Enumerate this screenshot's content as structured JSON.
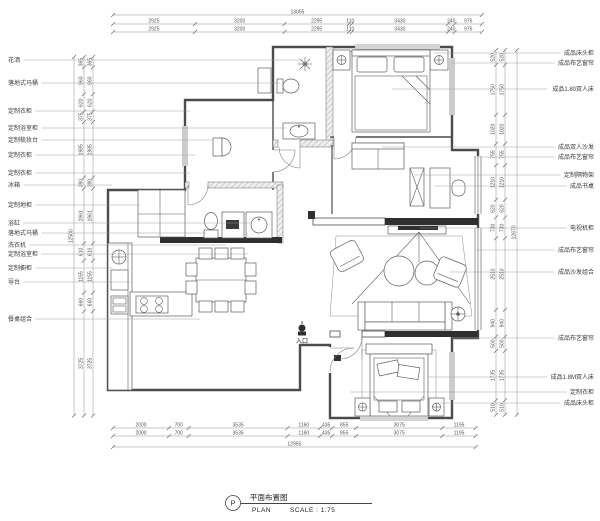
{
  "drawing_title": {
    "letter": "P",
    "title_cn": "平面布置图",
    "plan_label": "PLAN",
    "scale_label": "SCALE : 1:75"
  },
  "entry": {
    "label": "入口"
  },
  "colors": {
    "line": "#4b4b4b",
    "wall_fill": "#2f2f2f",
    "hatch": "#bdbdbd",
    "dim": "#8f8f8f"
  },
  "left_labels": [
    {
      "text": "花洒",
      "y": 60,
      "tx": 300
    },
    {
      "text": "落地式马桶",
      "y": 83,
      "tx": 280
    },
    {
      "text": "定制衣柜",
      "y": 111,
      "tx": 190
    },
    {
      "text": "定制浴室柜",
      "y": 128,
      "tx": 286
    },
    {
      "text": "定制梳妆台",
      "y": 140,
      "tx": 213
    },
    {
      "text": "定制衣柜",
      "y": 155,
      "tx": 195
    },
    {
      "text": "定制衣柜",
      "y": 173,
      "tx": 190
    },
    {
      "text": "冰箱",
      "y": 185,
      "tx": 112
    },
    {
      "text": "定制地柜",
      "y": 205,
      "tx": 140
    },
    {
      "text": "浴缸",
      "y": 223,
      "tx": 250
    },
    {
      "text": "落地式马桶",
      "y": 233,
      "tx": 206
    },
    {
      "text": "洗衣机",
      "y": 245,
      "tx": 226
    },
    {
      "text": "定制浴室柜",
      "y": 254,
      "tx": 248
    },
    {
      "text": "定制橱柜",
      "y": 268,
      "tx": 112
    },
    {
      "text": "导台",
      "y": 282,
      "tx": 130
    },
    {
      "text": "餐桌组合",
      "y": 319,
      "tx": 200
    }
  ],
  "right_labels": [
    {
      "text": "成品床头柜",
      "y": 53,
      "tx": 434
    },
    {
      "text": "成品布艺窗帘",
      "y": 63,
      "tx": 452
    },
    {
      "text": "成品1.80双人床",
      "y": 89,
      "tx": 392
    },
    {
      "text": "成品双人沙发",
      "y": 147,
      "tx": 382
    },
    {
      "text": "成品布艺窗帘",
      "y": 157,
      "tx": 474
    },
    {
      "text": "定制隔物架",
      "y": 175,
      "tx": 414
    },
    {
      "text": "成品书桌",
      "y": 186,
      "tx": 434
    },
    {
      "text": "电视机柜",
      "y": 228,
      "tx": 420
    },
    {
      "text": "成品布艺窗帘",
      "y": 250,
      "tx": 476
    },
    {
      "text": "成品沙发组合",
      "y": 272,
      "tx": 450
    },
    {
      "text": "成品布艺窗帘",
      "y": 338,
      "tx": 452
    },
    {
      "text": "成品1.8M双人床",
      "y": 377,
      "tx": 428
    },
    {
      "text": "定制衣柜",
      "y": 392,
      "tx": 350
    },
    {
      "text": "成品床头柜",
      "y": 403,
      "tx": 440
    }
  ],
  "dimensions": {
    "top": {
      "rows": [
        "2925",
        "3200",
        "2295",
        "110",
        "3430",
        "240",
        "975"
      ],
      "total": "13065"
    },
    "bottom": {
      "rows": [
        "2000",
        "700",
        "3535",
        "1160",
        "435",
        "855",
        "3075",
        "1195"
      ],
      "total": "12955"
    },
    "left": {
      "rows": [
        "365",
        "960",
        "620",
        "375",
        "1985",
        "390",
        "1961",
        "610",
        "1155",
        "660",
        "3725"
      ],
      "total": "12500"
    },
    "right": {
      "rows": [
        "520",
        "1750",
        "1020",
        "755",
        "1210",
        "620",
        "730",
        "2510",
        "940",
        "500",
        "1735",
        "510"
      ],
      "total": "12670"
    }
  }
}
